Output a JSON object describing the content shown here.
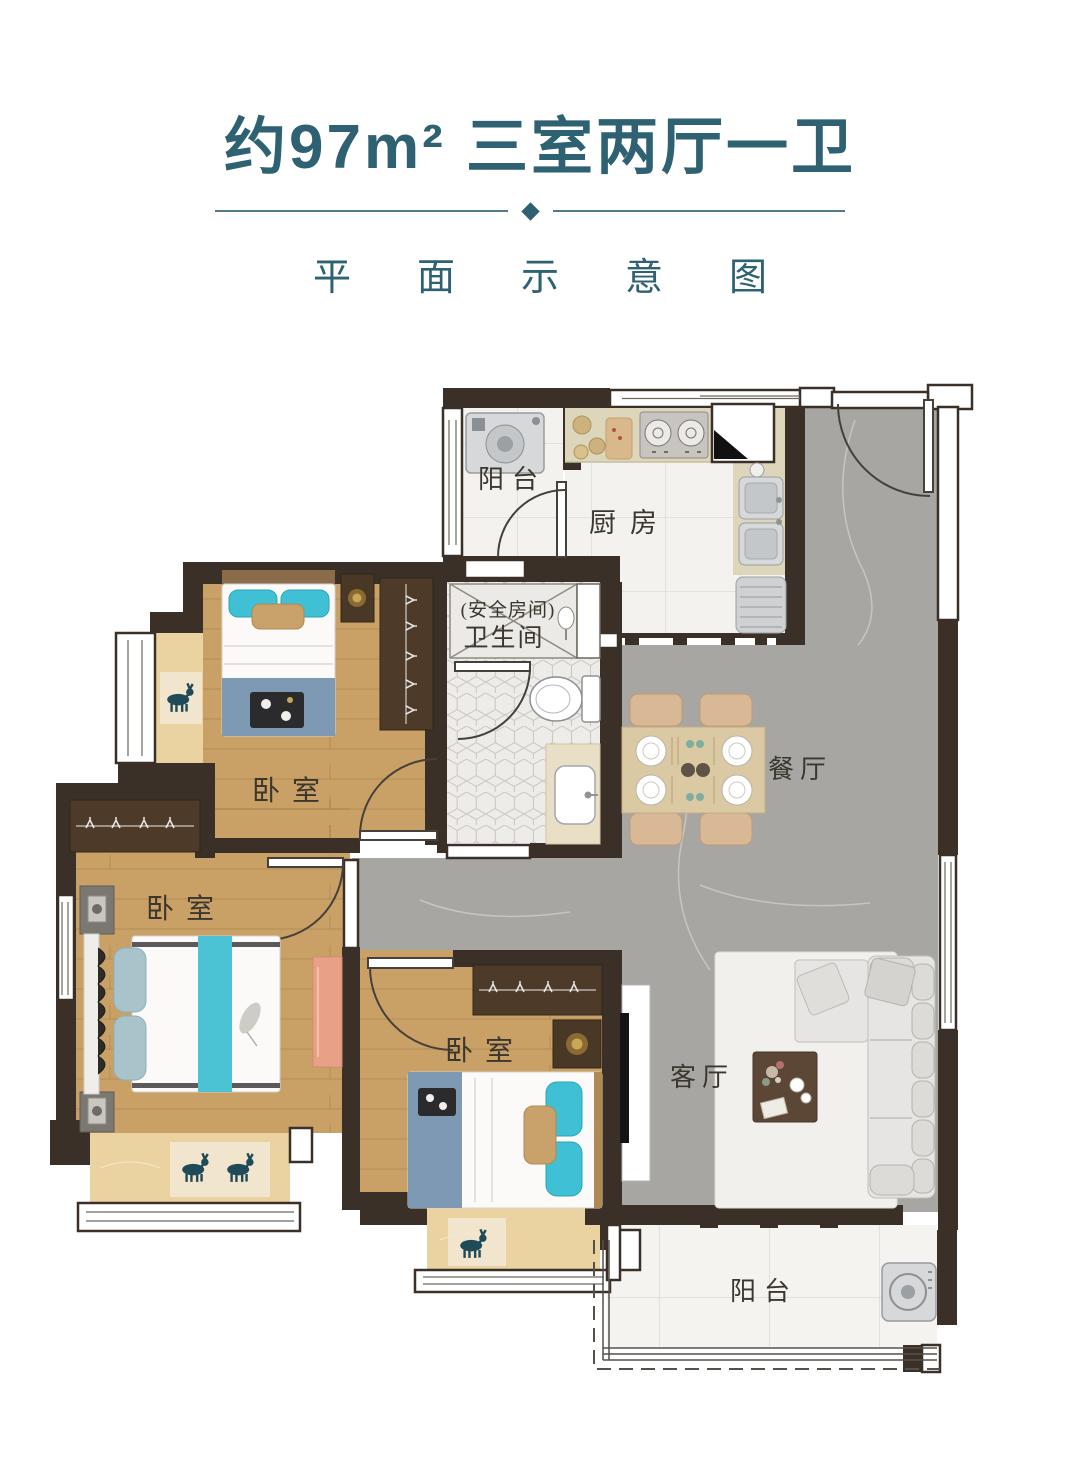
{
  "header": {
    "title": "约97m² 三室两厅一卫",
    "subtitle": "平面示意图"
  },
  "plan": {
    "labels": {
      "balcony_top": "阳台",
      "kitchen": "厨房",
      "safe_room": "(安全房间)",
      "bathroom": "卫生间",
      "bedroom_top": "卧室",
      "bedroom_left": "卧室",
      "bedroom_bottom": "卧室",
      "dining": "餐厅",
      "living": "客厅",
      "balcony_bottom": "阳台"
    }
  },
  "colors": {
    "accent_teal": "#2e6272",
    "wall": "#3a3028",
    "wood_floor": "#c9a167",
    "bay_wood": "#ead2a1",
    "marble_grey": "#a7a5a2",
    "tile_white": "#f3f2ef",
    "hex_tile": "#edece9",
    "counter_beige": "#ded6bb",
    "pillow_teal": "#3fc0d4",
    "blanket_blue": "#7e99b4",
    "sofa_grey": "#e6e5e3",
    "label_text": "#3b362e"
  }
}
